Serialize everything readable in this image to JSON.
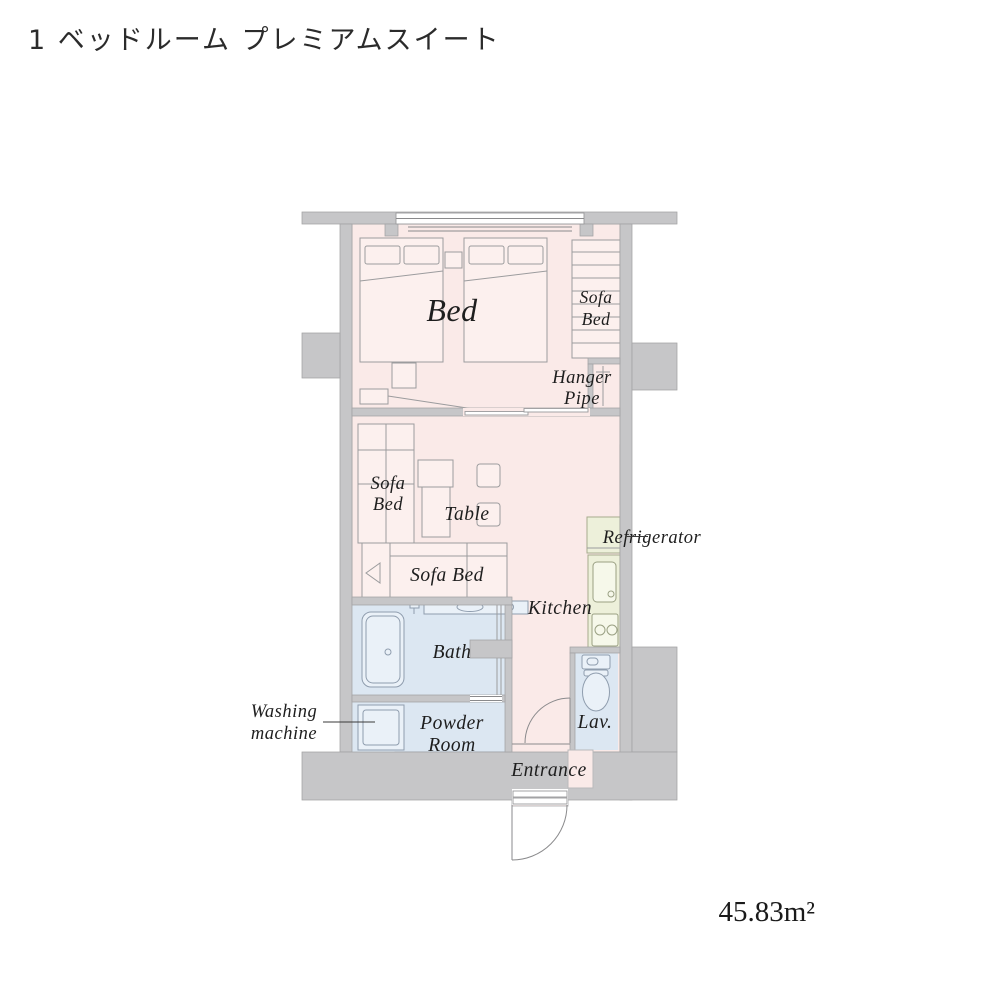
{
  "title": "1 ベッドルーム プレミアムスイート",
  "area": "45.83m²",
  "labels": {
    "bed": "Bed",
    "sofa_bed_bedroom_l1": "Sofa",
    "sofa_bed_bedroom_l2": "Bed",
    "hanger_l1": "Hanger",
    "hanger_l2": "Pipe",
    "sofa_bed_living_l1": "Sofa",
    "sofa_bed_living_l2": "Bed",
    "table": "Table",
    "sofa_bed_horizontal": "Sofa Bed",
    "refrigerator": "Refrigerator",
    "kitchen": "Kitchen",
    "bath": "Bath",
    "washing_l1": "Washing",
    "washing_l2": "machine",
    "powder_l1": "Powder",
    "powder_l2": "Room",
    "lav": "Lav.",
    "entrance": "Entrance"
  },
  "colors": {
    "wall_gray": "#c6c6c8",
    "room_pink": "#faeae8",
    "wet_area_blue": "#dce7f2",
    "kitchen_green": "#edf0da",
    "label_text": "#1e1e1e"
  }
}
